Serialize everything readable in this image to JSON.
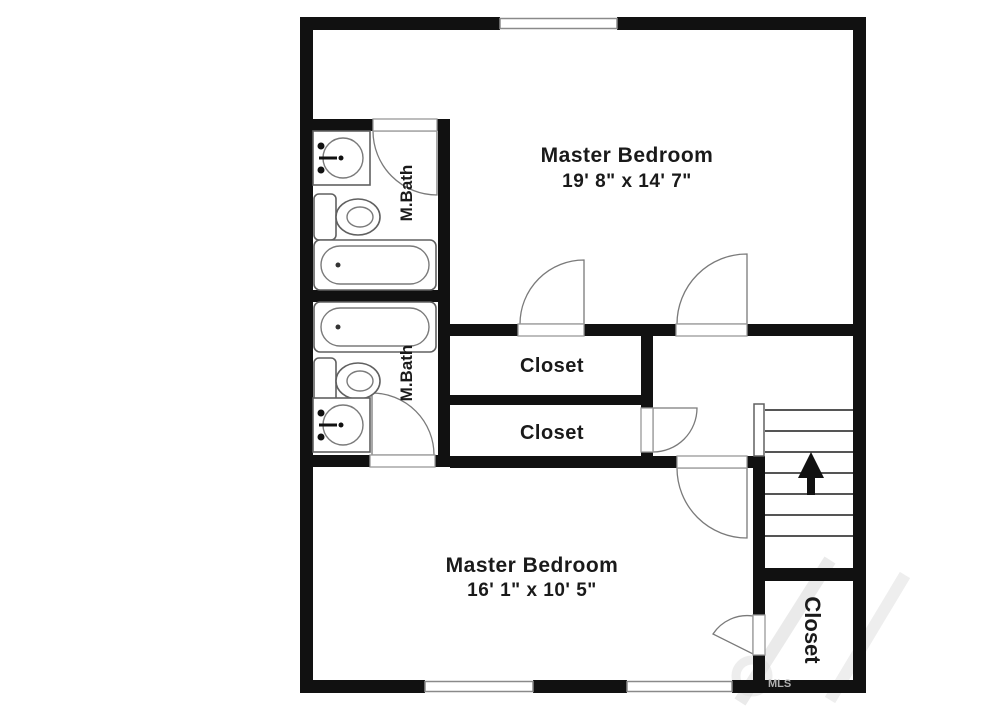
{
  "plan_title": "Second floor plan",
  "colors": {
    "wall": "#111111",
    "background": "#ffffff",
    "fixture_line": "#606060",
    "door_line": "#7a7a7a",
    "text": "#1a1a1a",
    "watermark": "#b0b0b0"
  },
  "rooms": {
    "master_top": {
      "name": "Master Bedroom",
      "dims": "19' 8\" x 14' 7\""
    },
    "master_bottom": {
      "name": "Master Bedroom",
      "dims": "16' 1\" x 10' 5\""
    },
    "bath_top": {
      "name": "M.Bath"
    },
    "bath_bottom": {
      "name": "M.Bath"
    },
    "closet_upper": {
      "name": "Closet"
    },
    "closet_lower": {
      "name": "Closet"
    },
    "closet_bottom_right": {
      "name": "Closet"
    }
  },
  "fixtures": {
    "bath_top": [
      "sink",
      "toilet",
      "bathtub"
    ],
    "bath_bottom": [
      "bathtub",
      "toilet",
      "sink"
    ]
  },
  "stairs": {
    "direction": "up"
  },
  "watermark": {
    "small": "MLS"
  }
}
